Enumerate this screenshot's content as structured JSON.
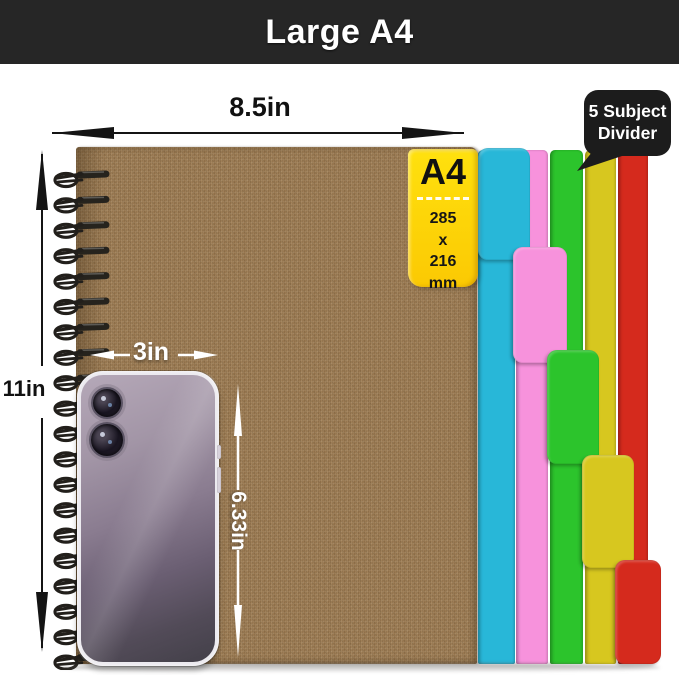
{
  "header": {
    "title": "Large A4"
  },
  "callout": {
    "line1": "5 Subject",
    "line2": "Divider"
  },
  "size_label": {
    "title": "A4",
    "line1": "285",
    "line2": "x",
    "line3": "216",
    "line4": "mm"
  },
  "width_dimension": {
    "label": "8.5in"
  },
  "height_dimension": {
    "label": "11in"
  },
  "phone_width_dimension": {
    "label": "3in"
  },
  "phone_height_dimension": {
    "label": "6.33in"
  },
  "colors": {
    "header_bg": "#262626",
    "header_text": "#ffffff",
    "callout_bg": "#1c1c1c",
    "size_label_yellow": "#fdd406",
    "notebook_cover_brown": "#997850",
    "dimension_arrow_black": "#141414",
    "white_annotation": "#ffffff",
    "spiral_wire": "#221f1b"
  },
  "dividers": [
    {
      "name": "cyan",
      "color": "#28b7d8",
      "strip": {
        "x": 478,
        "w": 37
      },
      "tab": {
        "x": 478,
        "w": 52,
        "y": 148,
        "h": 112
      }
    },
    {
      "name": "pink",
      "color": "#f792dc",
      "strip": {
        "x": 516,
        "w": 32
      },
      "tab": {
        "x": 513,
        "w": 54,
        "y": 247,
        "h": 116
      }
    },
    {
      "name": "green",
      "color": "#2cc42c",
      "strip": {
        "x": 550,
        "w": 33
      },
      "tab": {
        "x": 547,
        "w": 52,
        "y": 350,
        "h": 114
      }
    },
    {
      "name": "yellow",
      "color": "#d7c71f",
      "strip": {
        "x": 585,
        "w": 31
      },
      "tab": {
        "x": 582,
        "w": 52,
        "y": 455,
        "h": 113
      }
    },
    {
      "name": "red",
      "color": "#d52a1d",
      "strip": {
        "x": 618,
        "w": 30
      },
      "tab": {
        "x": 615,
        "w": 46,
        "y": 560,
        "h": 104
      }
    }
  ],
  "spiral": {
    "count": 20,
    "start_y": 24,
    "spacing": 25.4
  }
}
